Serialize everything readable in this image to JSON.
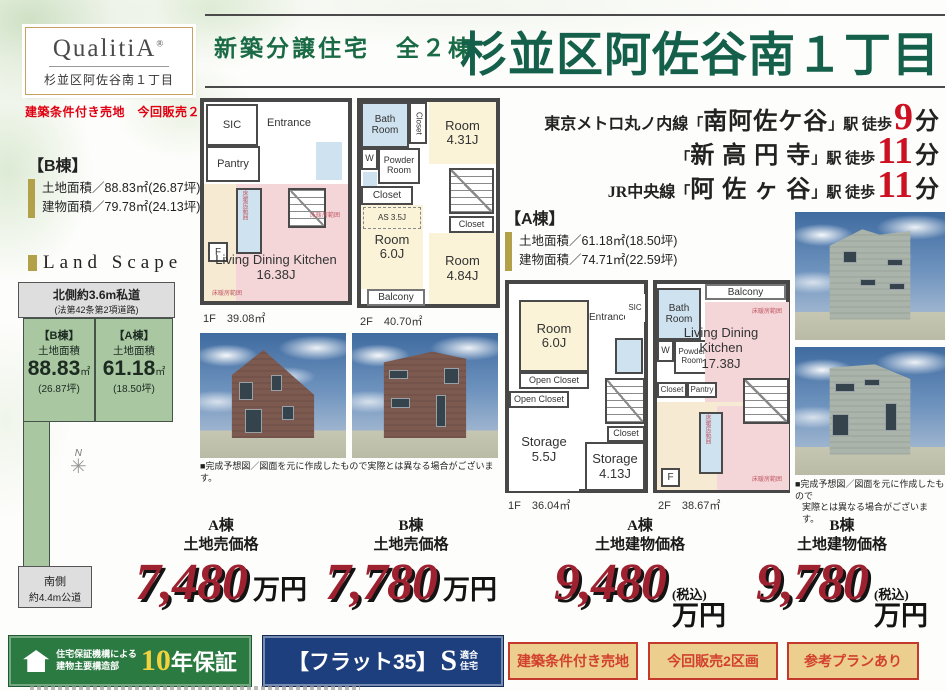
{
  "logo": {
    "brand": "QualitiA",
    "reg": "®",
    "subtitle": "杉並区阿佐谷南１丁目"
  },
  "sale_note": "建築条件付き売地　今回販売２区画",
  "header": {
    "lead": "新築分譲住宅　全２棟",
    "title": "杉並区阿佐谷南１丁目"
  },
  "access": [
    {
      "line": "東京メトロ丸ノ内線",
      "open": "「",
      "station": "南阿佐ケ谷",
      "close": "」",
      "suffix": "駅 徒歩",
      "minutes": "9",
      "unit": "分"
    },
    {
      "line": "",
      "open": "「",
      "station": "新 高 円 寺",
      "close": "」",
      "suffix": "駅 徒歩",
      "minutes": "11",
      "unit": "分"
    },
    {
      "line": "JR中央線",
      "open": "「",
      "station": "阿 佐 ヶ 谷",
      "close": "」",
      "suffix": "駅 徒歩",
      "minutes": "11",
      "unit": "分"
    }
  ],
  "b_info": {
    "name": "【B棟】",
    "land": "土地面積／88.83㎡(26.87坪)",
    "building": "建物面積／79.78㎡(24.13坪)"
  },
  "a_info": {
    "name": "【A棟】",
    "land": "土地面積／61.18㎡(18.50坪)",
    "building": "建物面積／74.71㎡(22.59坪)"
  },
  "landscape": {
    "heading": "Land Scape",
    "north_road": "北側約3.6m私道",
    "north_road_sub": "(法第42条第2項道路)",
    "south_road_1": "南側",
    "south_road_2": "約4.4m公道",
    "compass": "N",
    "plot_b": {
      "name": "【B棟】",
      "label": "土地面積",
      "area": "88.83",
      "unit": "㎡",
      "tsubo": "(26.87坪)"
    },
    "plot_a": {
      "name": "【A棟】",
      "label": "土地面積",
      "area": "61.18",
      "unit": "㎡",
      "tsubo": "(18.50坪)"
    }
  },
  "plans": {
    "b1f": {
      "sic": "SIC",
      "entrance": "Entrance",
      "pantry": "Pantry",
      "f": "F",
      "ldk": "Living Dining Kitchen",
      "ldk_size": "16.38J",
      "heated": "床暖房範囲",
      "area": "1F　39.08㎡"
    },
    "b2f": {
      "bath": "Bath Room",
      "closet1": "Closet",
      "room1": "Room",
      "room1_size": "4.31J",
      "w": "W",
      "powder": "Powder Room",
      "closet2": "Closet",
      "as": "AS 3.5J",
      "room2": "Room",
      "room2_size": "6.0J",
      "closet3": "Closet",
      "room3": "Room",
      "room3_size": "4.84J",
      "balcony": "Balcony",
      "area": "2F　40.70㎡"
    },
    "a1f": {
      "room": "Room",
      "room_size": "6.0J",
      "entrance": "Entrance",
      "sic": "SIC",
      "oc1": "Open Closet",
      "oc2": "Open Closet",
      "storage1": "Storage",
      "storage1_size": "5.5J",
      "closet": "Closet",
      "storage2": "Storage",
      "storage2_size": "4.13J",
      "area": "1F　36.04㎡"
    },
    "a2f": {
      "balcony": "Balcony",
      "bath": "Bath Room",
      "w": "W",
      "powder": "Powder Room",
      "closet": "Closet",
      "pantry": "Pantry",
      "ldk": "Living Dining Kitchen",
      "ldk_size": "17.38J",
      "f": "F",
      "heated": "床暖房範囲",
      "area": "2F　38.67㎡"
    }
  },
  "photos": {
    "caption_mid": "■完成予想図／図面を元に作成したもので実際とは異なる場合がございます。",
    "caption_right_1": "■完成予想図／図面を元に作成したもので",
    "caption_right_2": "実際とは異なる場合がございます。"
  },
  "prices": [
    {
      "building": "A棟",
      "type": "土地売価格",
      "value": "7,480",
      "tax": "",
      "unit": "万円"
    },
    {
      "building": "B棟",
      "type": "土地売価格",
      "value": "7,780",
      "tax": "",
      "unit": "万円"
    },
    {
      "building": "A棟",
      "type": "土地建物価格",
      "value": "9,480",
      "tax": "(税込)",
      "unit": "万円"
    },
    {
      "building": "B棟",
      "type": "土地建物価格",
      "value": "9,780",
      "tax": "(税込)",
      "unit": "万円"
    }
  ],
  "badges": {
    "warranty": {
      "l1": "住宅保証機構による",
      "l2": "建物主要構造部",
      "num": "10",
      "rest": "年保証"
    },
    "flat35": {
      "bracket": "【フラット35】",
      "s": "S",
      "sub1": "適合",
      "sub2": "住宅"
    },
    "tags": [
      "建築条件付き売地",
      "今回販売2区画",
      "参考プランあり"
    ]
  },
  "colors": {
    "title_green": "#14604a",
    "minutes_red": "#cc1122",
    "price_red": "#9e2130",
    "tag_red": "#d2402e",
    "plot_green": "#a9c7a1",
    "warranty_green": "#2b7a41",
    "flat_blue": "#1e3f7d"
  }
}
